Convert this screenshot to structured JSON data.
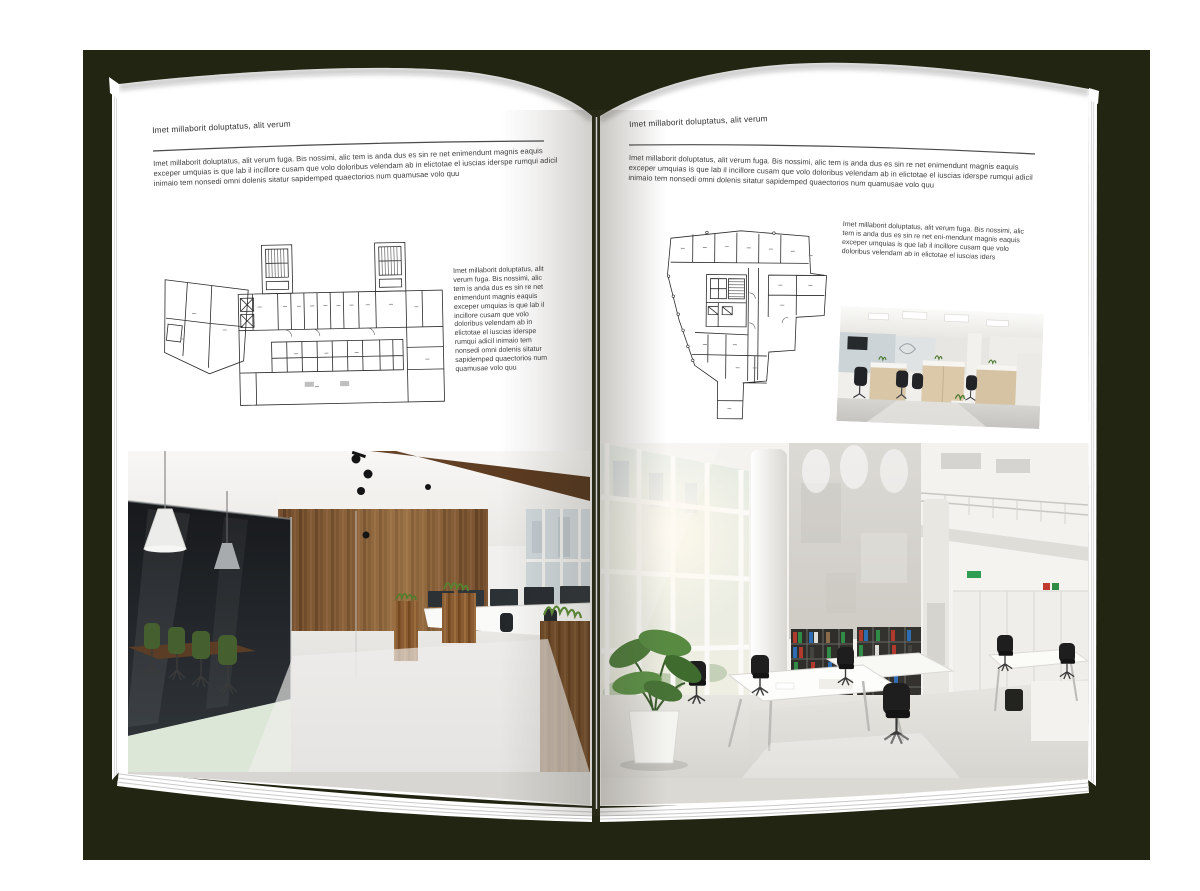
{
  "scene": {
    "type": "open-magazine-spread"
  },
  "colors": {
    "backdrop": "#222511",
    "page": "#ffffff",
    "ink": "#3c3c3c",
    "rule": "#4a4a4a",
    "wood": "#74502f",
    "plant_green": "#4e7a2e",
    "binder_red": "#b03a2e",
    "binder_green": "#2f8b45",
    "binder_blue": "#2f6db3"
  },
  "left_page": {
    "header": "Imet millaborit doluptatus, alit verum",
    "intro": "Imet millaborit doluptatus, alit verum fuga. Bis nossimi, alic tem is anda dus es sin re net enimendunt magnis eaquis exceper umquias is que lab il incillore cusam que volo doloribus velendam ab in elictotae el iuscias iderspe rumqui adicil inimaio tem nonsedi omni dolenis sitatur sapidemped quaectorios num quamusae volo quu",
    "side_text": "Imet millaborit doluptatus, alit verum fuga. Bis nossimi, alic tem is anda dus es sin re net enimendunt magnis eaquis exceper umquias is que lab il incillore cusam que volo doloribus velendam ab in elictotae el iuscias iderspe rumqui adicil inimaio tem nonsedi omni dolenis sitatur sapidemped quaectorios num quamusae volo quu",
    "images": {
      "floorplan": "architectural-floor-plan-wide-building",
      "photo": "office-interior-wood-wall-glass-meeting-room"
    }
  },
  "right_page": {
    "header": "Imet millaborit doluptatus, alit verum",
    "intro": "Imet millaborit doluptatus, alit verum fuga. Bis nossimi, alic tem is anda dus es sin re net enimendunt magnis eaquis exceper umquias is que lab il incillore cusam que volo doloribus velendam ab in elictotae el iuscias iderspe rumqui adicil inimaio tem nonsedi omni dolenis sitatur sapidemped quaectorios num quamusae volo quu",
    "side_text": "Imet millaborit doluptatus, alit verum fuga. Bis nossimi, alic tem is anda dus es sin re net eni-mendunt magnis eaquis exceper umquias is que lab il incillore cusam que volo doloribus velendam ab in elictotae el iuscias iders",
    "images": {
      "floorplan": "architectural-floor-plan-tower-block",
      "photo_small": "office-interior-open-plan-desks",
      "photo_large": "office-interior-atrium-bookshelves"
    }
  }
}
